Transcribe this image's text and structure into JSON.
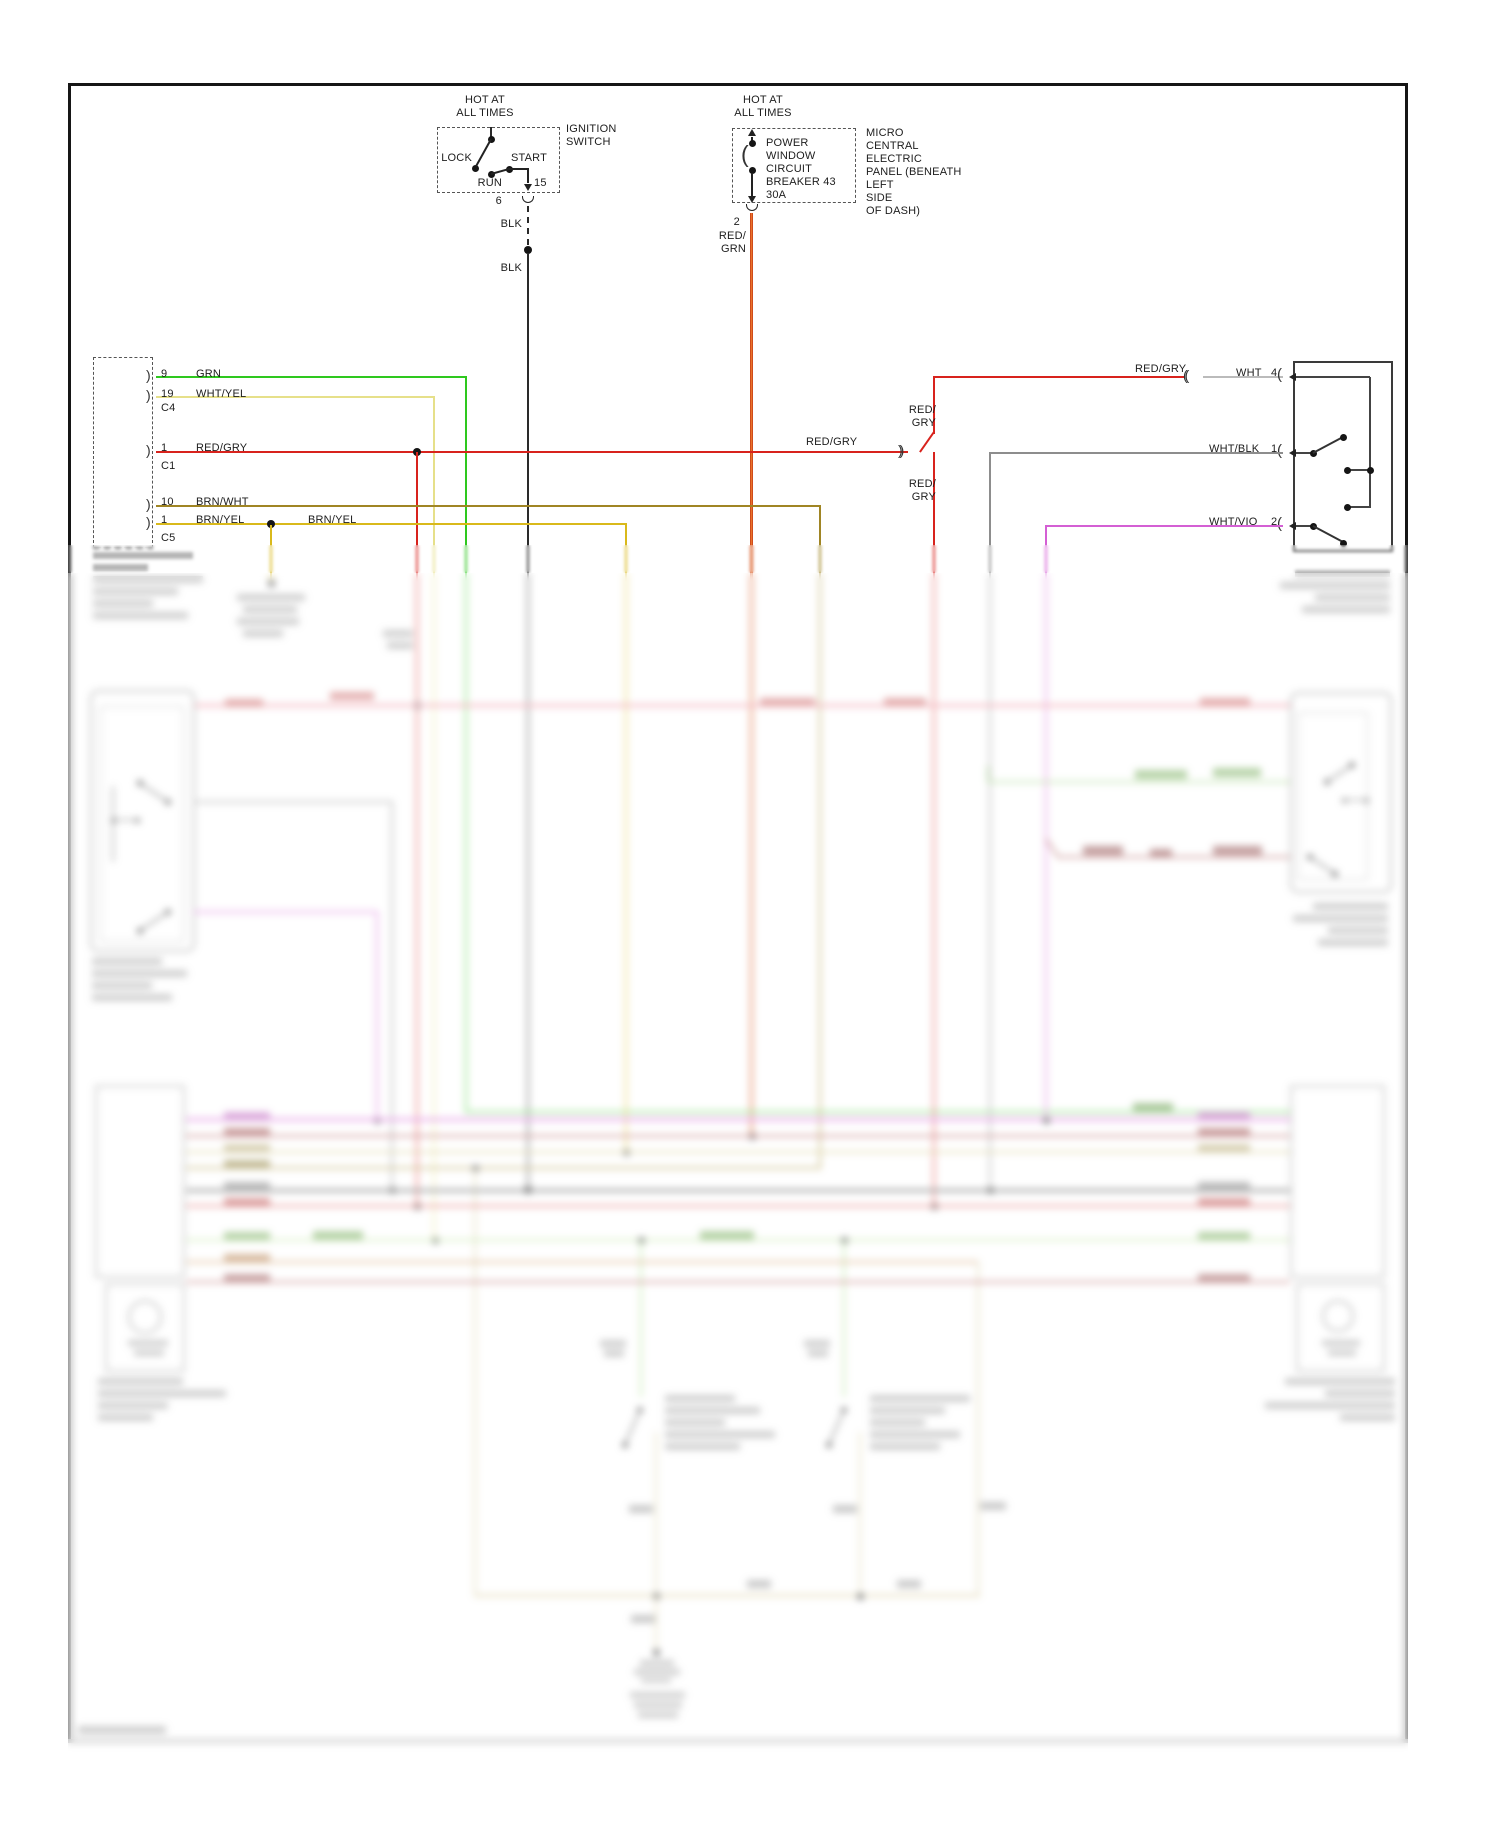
{
  "ignition": {
    "hot_line1": "HOT AT",
    "hot_line2": "ALL TIMES",
    "name_line1": "IGNITION",
    "name_line2": "SWITCH",
    "lock": "LOCK",
    "start": "START",
    "run": "RUN",
    "terminal": "15",
    "pin": "6",
    "wire": "BLK"
  },
  "breaker": {
    "hot_line1": "HOT AT",
    "hot_line2": "ALL TIMES",
    "name_lines": [
      "POWER",
      "WINDOW",
      "CIRCUIT",
      "BREAKER 43",
      "30A"
    ],
    "panel_lines": [
      "MICRO",
      "CENTRAL",
      "ELECTRIC",
      "PANEL (BENEATH",
      "LEFT",
      "SIDE",
      "OF DASH)"
    ],
    "pin": "2",
    "wire_line1": "RED/",
    "wire_line2": "GRN"
  },
  "left_connector": {
    "pin1_num": "9",
    "pin1_wire": "GRN",
    "pin2_num": "19",
    "pin2_wire": "WHT/YEL",
    "conn_c4": "C4",
    "pin3_num": "1",
    "pin3_wire": "RED/GRY",
    "conn_c1": "C1",
    "pin4_num": "10",
    "pin4_wire": "BRN/WHT",
    "pin5_num": "1",
    "pin5_wire": "BRN/YEL",
    "conn_c5": "C5",
    "splice_label": "BRN/YEL"
  },
  "feed": {
    "label_left": "RED/GRY",
    "upper_line1": "RED/",
    "upper_line2": "GRY",
    "lower_line1": "RED/",
    "lower_line2": "GRY",
    "label_right": "RED/GRY"
  },
  "right_switch": {
    "pin4_wire": "WHT",
    "pin4_num": "4",
    "pin1_wire": "WHT/BLK",
    "pin1_num": "1",
    "pin2_wire": "WHT/VIO",
    "pin2_num": "2"
  },
  "wire_colors": {
    "BLK": "#2a2a2a",
    "GRN": "#2ec81e",
    "WHT_YEL": "#e6e08a",
    "RED_GRY": "#d8231d",
    "BRN_WHT": "#a08524",
    "BRN_YEL": "#d9b91b",
    "RED_GRN": "#e06818",
    "WHT": "#bbbbbb",
    "WHT_BLK": "#8d8d8d",
    "WHT_VIO": "#d45fd4"
  }
}
